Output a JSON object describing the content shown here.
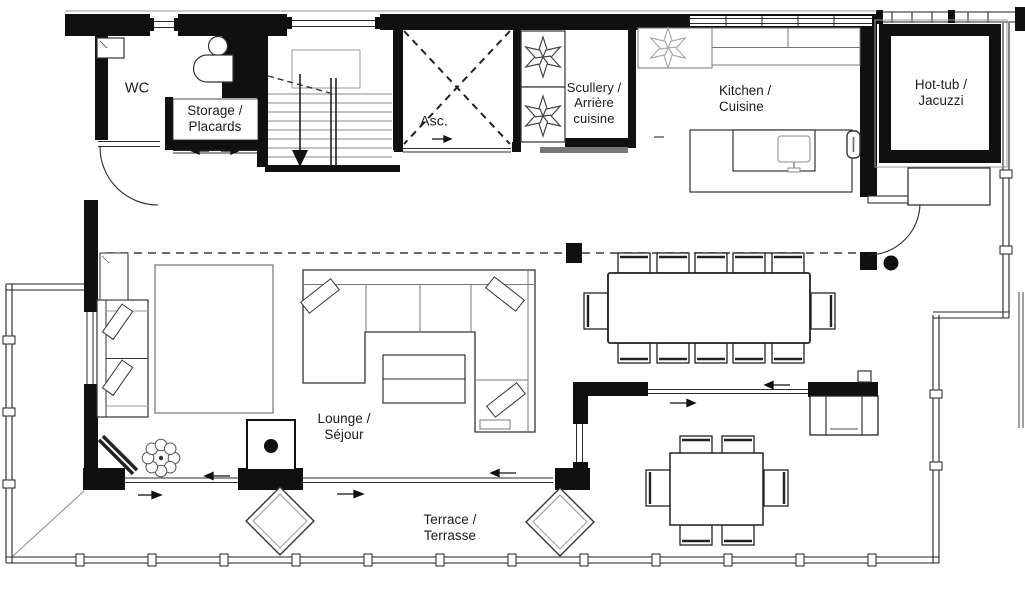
{
  "canvas": {
    "width": 1025,
    "height": 601,
    "kind": "floor-plan"
  },
  "palette": {
    "wall": "#101010",
    "line": "#2b2b2b",
    "muted": "#9a9a9a",
    "background": "#ffffff"
  },
  "rooms": {
    "wc": {
      "label": "WC"
    },
    "storage": {
      "label": "Storage /\nPlacards"
    },
    "elevator": {
      "label": "Asc."
    },
    "scullery": {
      "label": "Scullery /\nArrière\ncuisine"
    },
    "kitchen": {
      "label": "Kitchen /\nCuisine"
    },
    "hot_tub": {
      "label": "Hot-tub /\nJacuzzi"
    },
    "lounge": {
      "label": "Lounge /\nSéjour"
    },
    "terrace": {
      "label": "Terrace /\nTerrasse"
    }
  }
}
